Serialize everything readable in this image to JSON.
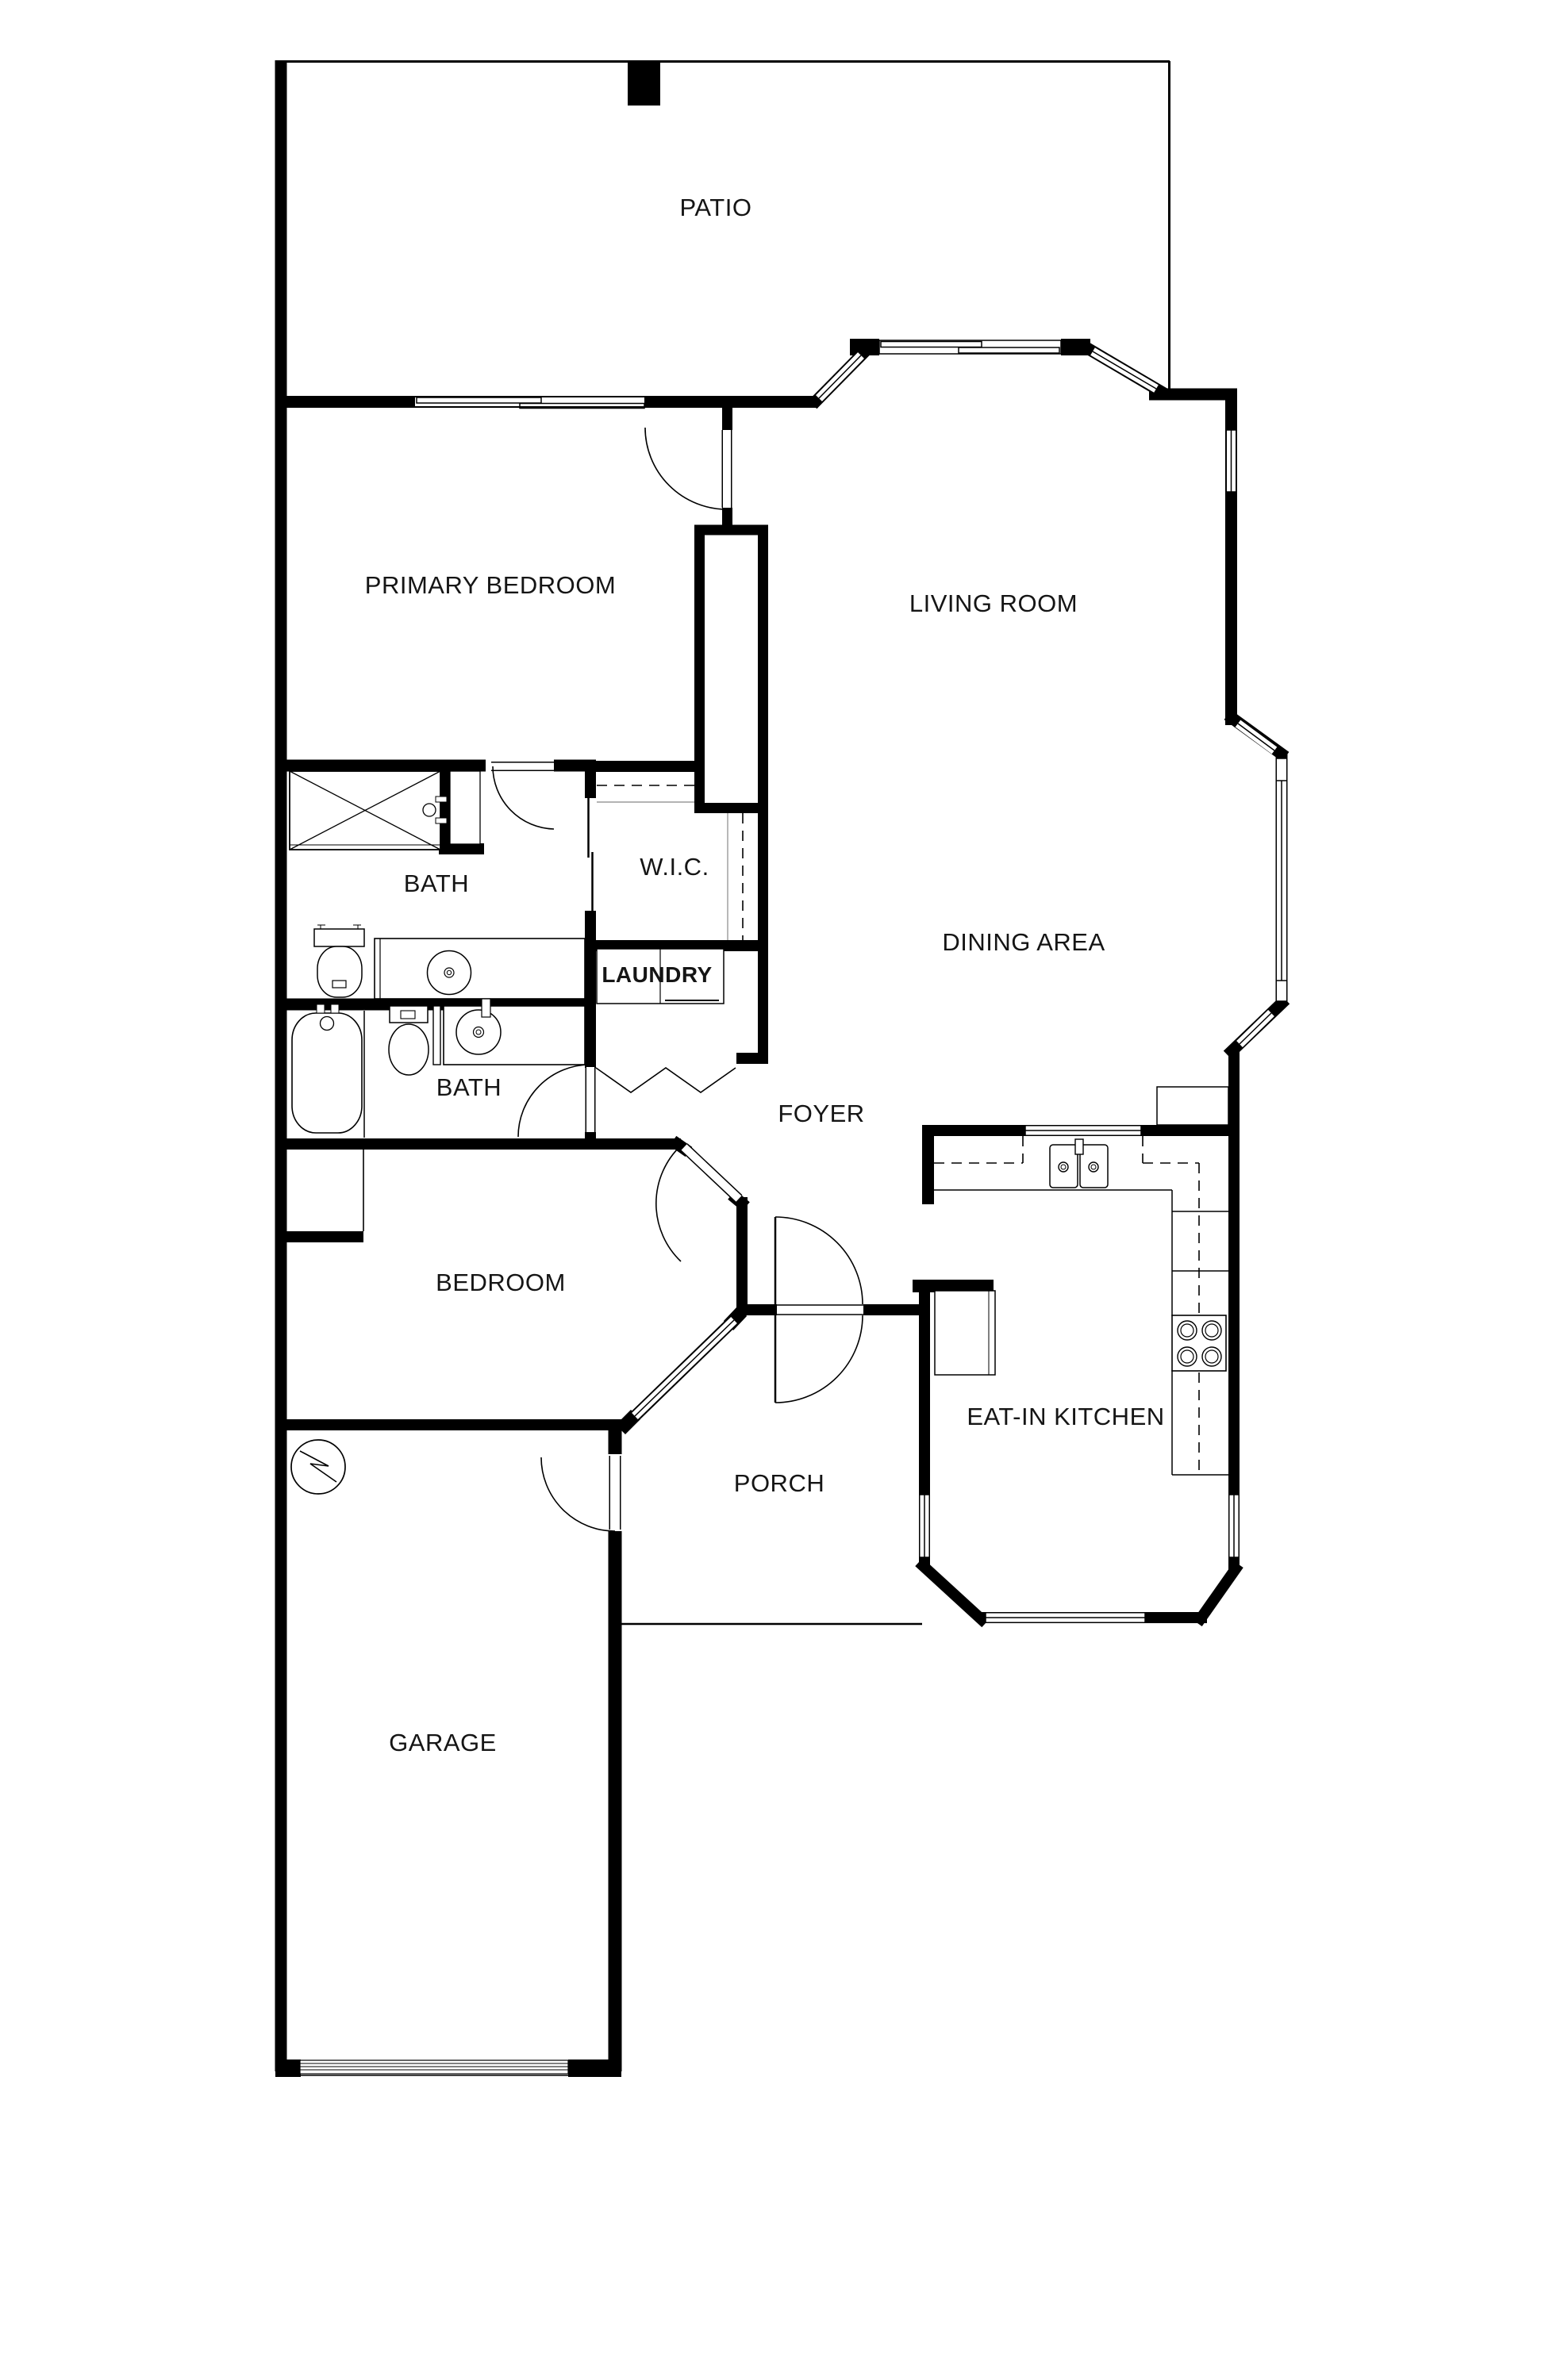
{
  "plan": {
    "type": "residential-floor-plan",
    "background": "#ffffff",
    "wall_color": "#000000",
    "label_color": "#151515"
  },
  "rooms": {
    "patio": {
      "label": "PATIO"
    },
    "primary_bedroom": {
      "label": "PRIMARY BEDROOM"
    },
    "living_room": {
      "label": "LIVING ROOM"
    },
    "primary_bath": {
      "label": "BATH"
    },
    "walk_in_closet": {
      "label": "W.I.C."
    },
    "laundry": {
      "label": "LAUNDRY"
    },
    "dining_area": {
      "label": "DINING AREA"
    },
    "hall_bath": {
      "label": "BATH"
    },
    "foyer": {
      "label": "FOYER"
    },
    "bedroom": {
      "label": "BEDROOM"
    },
    "eat_in_kitchen": {
      "label": "EAT-IN KITCHEN"
    },
    "porch": {
      "label": "PORCH"
    },
    "garage": {
      "label": "GARAGE"
    }
  },
  "fixtures": {
    "primary_bath": [
      "shower",
      "toilet",
      "vanity-sink"
    ],
    "hall_bath": [
      "bathtub",
      "toilet",
      "vanity-sink"
    ],
    "laundry": [
      "washer-dryer"
    ],
    "kitchen": [
      "double-sink",
      "range-cooktop",
      "refrigerator",
      "peninsula-counter"
    ],
    "garage": [
      "water-heater",
      "garage-door"
    ]
  }
}
